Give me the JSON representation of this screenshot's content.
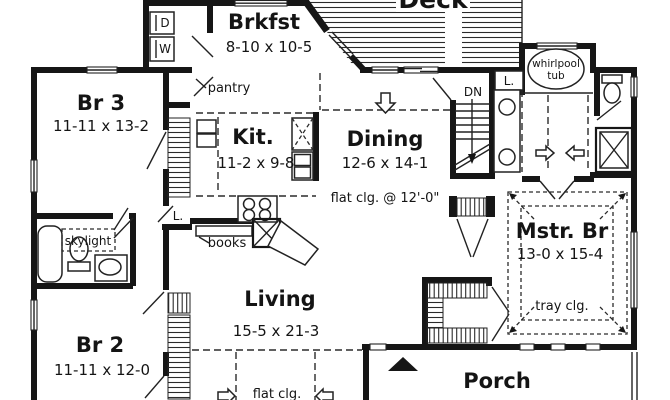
{
  "title": "First floor plan",
  "colors": {
    "ink": "#161616",
    "paper": "#ffffff"
  },
  "rooms": {
    "deck": {
      "label": "Deck"
    },
    "brkfst": {
      "label": "Brkfst",
      "dims": "8-10 x 10-5"
    },
    "br3": {
      "label": "Br 3",
      "dims": "11-11 x 13-2"
    },
    "kitchen": {
      "label": "Kit.",
      "dims": "11-2 x 9-8"
    },
    "dining": {
      "label": "Dining",
      "dims": "12-6 x 14-1",
      "ceiling_note": "flat clg. @ 12'-0\""
    },
    "living": {
      "label": "Living",
      "dims": "15-5 x 21-3",
      "ceiling_note": "flat clg."
    },
    "br2": {
      "label": "Br 2",
      "dims": "11-11 x 12-0"
    },
    "master": {
      "label": "Mstr. Br",
      "dims": "13-0 x 15-4",
      "ceiling_note": "tray clg."
    },
    "porch": {
      "label": "Porch"
    }
  },
  "fixtures": {
    "whirlpool_line1": "whirlpool",
    "whirlpool_line2": "tub",
    "pantry": "pantry",
    "skylight": "skylight",
    "books": "books",
    "stairs_down": "DN",
    "linen_hall": "L.",
    "linen_master": "L.",
    "dryer": "D",
    "washer": "W"
  }
}
